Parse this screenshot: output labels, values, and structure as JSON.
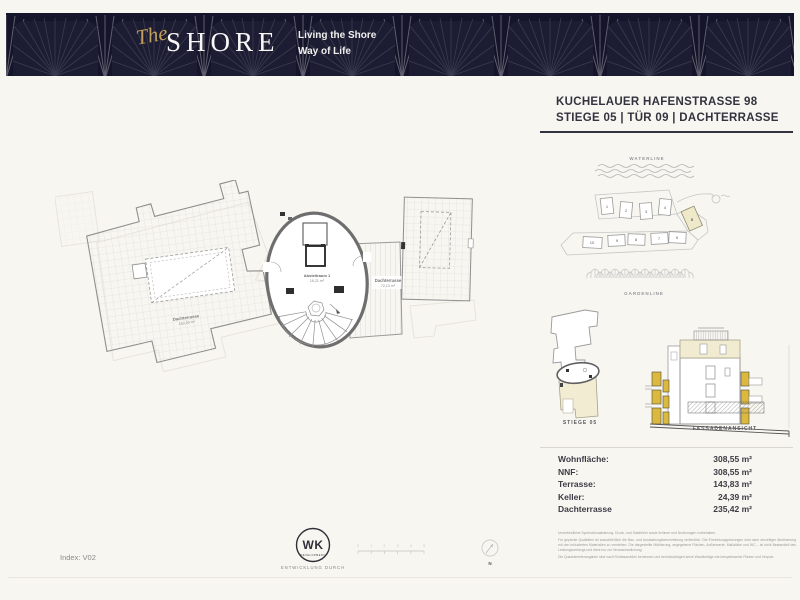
{
  "header": {
    "logo_script": "The",
    "logo_main": "SHORE",
    "tagline1": "Living the Shore",
    "tagline2": "Way of Life"
  },
  "address": {
    "line1": "KUCHELAUER HAFENSTRASSE 98",
    "line2": "STIEGE 05 | TÜR 09 | DACHTERRASSE"
  },
  "site_plan": {
    "waterline": "WATERLINE",
    "gardenline": "GARDENLINE",
    "top": [
      "1",
      "2",
      "3",
      "4"
    ],
    "five": "5",
    "bottom": [
      "10",
      "9",
      "8",
      "7",
      "6"
    ]
  },
  "floor_plan": {
    "terrace_left_label": "Dachterrasse",
    "terrace_left_area": "163,29 m²",
    "core_room_label": "Abstellraum 1",
    "core_room_area": "16,21 m²",
    "terrace_mid_label": "Dachterrasse",
    "terrace_mid_area": "72,13 m²"
  },
  "mini_plan": {
    "label": "STIEGE 05"
  },
  "facade": {
    "label": "FASSADENANSICHT"
  },
  "areas": {
    "rows": [
      {
        "label": "Wohnfläche:",
        "value": "308,55 m²"
      },
      {
        "label": "NNF:",
        "value": "308,55 m²"
      },
      {
        "label": "Terrasse:",
        "value": "143,83 m²"
      },
      {
        "label": "Keller:",
        "value": "24,39 m²"
      },
      {
        "label": "Dachterrasse",
        "value": "235,42 m²"
      }
    ]
  },
  "disclaimer": {
    "p1": "Unverbindliche Symbolvisualisierung. Druck- und Satzfehler sowie Irrtümer und Änderungen vorbehalten.",
    "p2": "Für geplante Qualitäten ist ausschließlich die Bau- und Ausstattungsbeschreibung verbindlich. Die Einrichtungsplanungen sind nach derzeitiger Abstimmung mit den inkludierten Materialien zu verstehen. Die dargestellte Möblierung, angegebene Flächen, Außenwerte, Maßstäbe und WC – ist nicht Bestandteil des Leistungsumfangs und dient nur zur Veranschaulichung.",
    "p3": "Die Quadratmeterangaben sind nach Rohbaumaßen bemessen und berücksichtigen keine Wandbeläge wie beispielsweise Fliesen und Verputz."
  },
  "footer": {
    "index_label": "Index: V02",
    "wk_logo": "WK",
    "wk_sub": "DEVELOPMENT",
    "developed_by": "ENTWICKLUNG DURCH",
    "compass": "N",
    "scale_ticks": [
      "0",
      "1",
      "2",
      "3",
      "4",
      "5"
    ]
  },
  "colors": {
    "brand_navy": "#14142a",
    "brand_gold": "#c5a05c",
    "highlight_cream": "#efe8c9",
    "facade_yellow": "#dcb93e"
  }
}
